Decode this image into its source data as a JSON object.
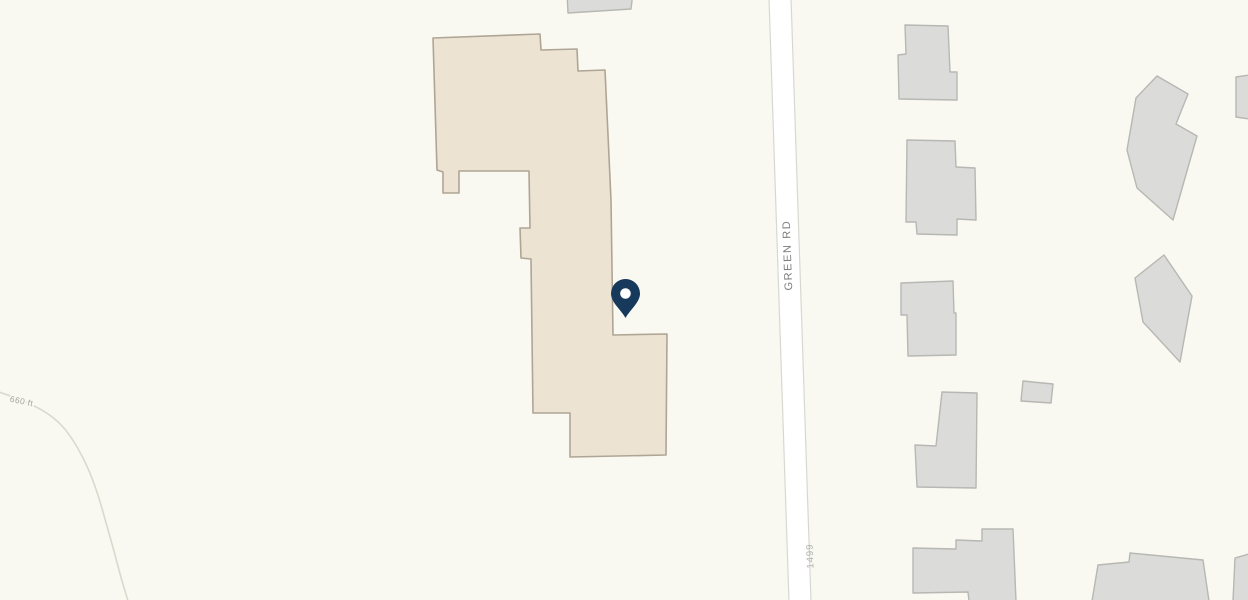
{
  "map": {
    "road_label": "GREEN RD",
    "address_label": "1499",
    "contour_label": "660 ft"
  },
  "colors": {
    "background": "#F9F8F1",
    "highlight_building_fill": "#EDE3D3",
    "highlight_building_stroke": "#AFA595",
    "building_fill": "#DBDBD9",
    "building_stroke": "#B7B7B3",
    "road_fill": "#FFFFFF",
    "road_border": "#D8D8D3",
    "road_label_color": "#7E7E7C",
    "address_label_color": "#B2B2AE",
    "contour_line_color": "#DCD8CC",
    "contour_label_color": "#A8A49B",
    "pin_color": "#17395C",
    "pin_hole_color": "#FFFFFF"
  }
}
